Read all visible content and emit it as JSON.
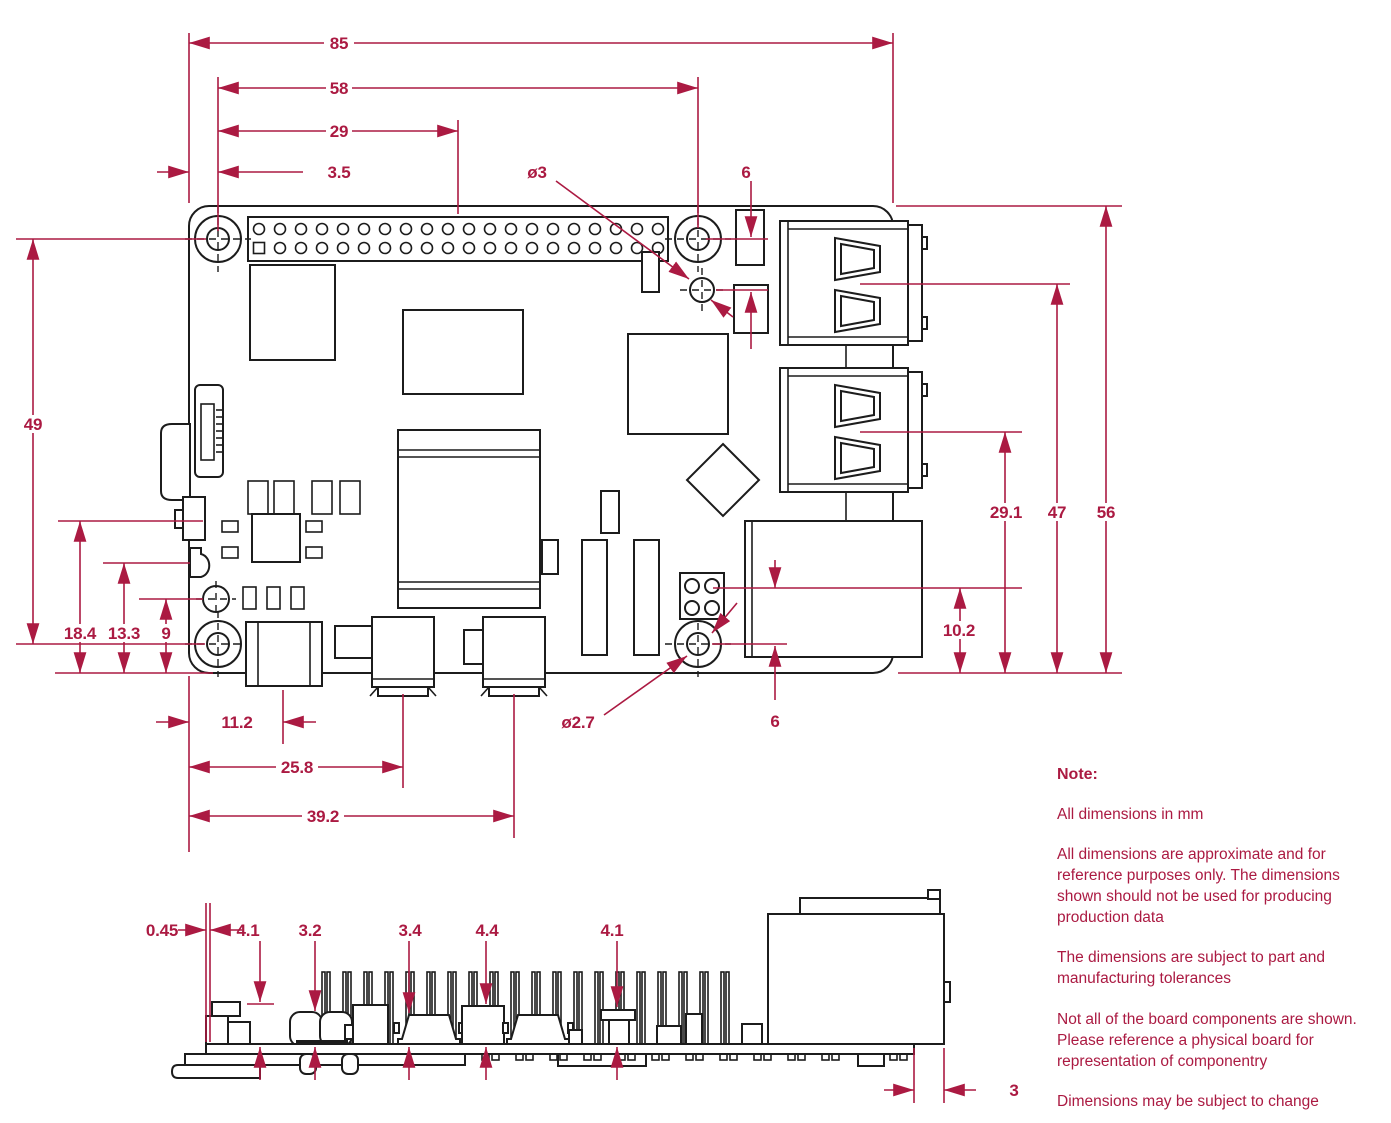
{
  "drawing": {
    "title": "Raspberry Pi board mechanical dimension drawing",
    "units": "mm",
    "colors": {
      "dimension_accent": "#ab1a42",
      "line": "#1c1c1c",
      "background": "#ffffff"
    },
    "labels": {
      "board_width": "85",
      "hole_span_horizontal": "58",
      "hole_to_gpio_center": "29",
      "edge_to_hole": "3.5",
      "top_hole_diameter": "ø3",
      "top_hole_offset": "6",
      "hole_span_vertical": "49",
      "left_feature_1": "18.4",
      "left_feature_2": "13.3",
      "left_feature_3": "9",
      "usbc_center_offset": "11.2",
      "hdmi0_center_offset": "25.8",
      "hdmi1_center_offset": "39.2",
      "mount_hole_diameter": "ø2.7",
      "eth_to_hole_offset": "6",
      "usb_lower_center": "29.1",
      "usb_upper_center": "47",
      "board_height": "56",
      "eth_center_height": "10.2",
      "side_gap": "0.45",
      "side_height_1": "4.1",
      "side_height_2": "3.2",
      "side_height_3": "3.4",
      "side_height_4": "4.4",
      "side_height_5": "4.1",
      "side_overhang": "3"
    },
    "notes": {
      "title": "Note:",
      "paragraphs": [
        "All dimensions in mm",
        "All dimensions are approximate and for reference purposes only. The dimensions shown should not be used for producing production data",
        "The dimensions are subject to part and manufacturing tolerances",
        "Not all of the board components are shown. Please reference a physical board for representation of componentry",
        "Dimensions may be subject to change"
      ]
    }
  }
}
